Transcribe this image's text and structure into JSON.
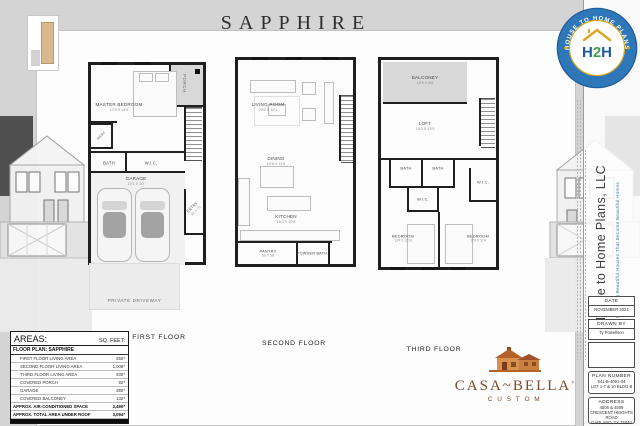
{
  "sheet": {
    "title": "SAPPHIRE"
  },
  "badge": {
    "arc_top": "HOUSE TO HOME PLANS",
    "arc_bottom": "DESIGNING BEAUTIFUL HOUSES THAT BECOME BEAUTIFUL HOMES",
    "m1": "H",
    "m2": "2",
    "m3": "H",
    "ring_color": "#2e77b8",
    "gold_color": "#d9a821",
    "green_color": "#3fa14f"
  },
  "floors": [
    {
      "label": "FIRST FLOOR",
      "rooms": {
        "porch": {
          "name": "PORCH"
        },
        "master": {
          "name": "MASTER BEDROOM",
          "dims": "17'3 X 14'6"
        },
        "wash": {
          "name": "WASH"
        },
        "bath": {
          "name": "BATH"
        },
        "wic": {
          "name": "W.I.C."
        },
        "garage": {
          "name": "GARAGE",
          "dims": "19'1 X 20'"
        },
        "entry": {
          "name": "ENTRY",
          "dims": "4'2 X 7'2"
        },
        "driveway": {
          "name": "PRIVATE DRIVEWAY"
        }
      }
    },
    {
      "label": "SECOND FLOOR",
      "rooms": {
        "living": {
          "name": "LIVING ROOM",
          "dims": "20'6 X 16'1"
        },
        "dining": {
          "name": "DINING",
          "dims": "14'8 X 11'6"
        },
        "kitchen": {
          "name": "KITCHEN",
          "dims": "15'3 X 10'8"
        },
        "pantry": {
          "name": "PANTRY",
          "dims": "5'8 X 5'8"
        },
        "powder": {
          "name": "POWDER BATH"
        }
      }
    },
    {
      "label": "THIRD FLOOR",
      "rooms": {
        "balcony": {
          "name": "BALCONEY",
          "dims": "19'9 X 6'6"
        },
        "loft": {
          "name": "LOFT",
          "dims": "15'3 X 13'9"
        },
        "bath1": {
          "name": "BATH"
        },
        "bath2": {
          "name": "BATH"
        },
        "wic1": {
          "name": "W.I.C."
        },
        "wic2": {
          "name": "W.I.C."
        },
        "bed1": {
          "name": "BEDROOM",
          "dims": "13'4 X 11'10"
        },
        "bed2": {
          "name": "BEDROOM",
          "dims": "12'4 X 11'4"
        }
      }
    }
  ],
  "areas_table": {
    "title": "AREAS:",
    "unit_header": "SQ. FEET:",
    "plan_row": "FLOOR PLAN: SAPPHIRE",
    "rows": [
      {
        "label": "FIRST FLOOR LIVING AREA",
        "value": "550*"
      },
      {
        "label": "SECOND FLOOR LIVING AREA",
        "value": "1,008*"
      },
      {
        "label": "THIRD FLOOR LIVING AREA",
        "value": "930*"
      },
      {
        "label": "COVERED PORCH",
        "value": "92*"
      },
      {
        "label": "GARAGE",
        "value": "380*"
      },
      {
        "label": "COVERED BALCONEY",
        "value": "132*"
      },
      {
        "label": "APPROX. AIR-CONDITIONED SPACE",
        "value": "2,490*"
      },
      {
        "label": "APPROX. TOTAL AREA UNDER ROOF",
        "value": "3,094*"
      }
    ]
  },
  "builder": {
    "name": "CASA~BELLA",
    "registered": "®",
    "sub": "C U S T O M",
    "brand_color": "#7a4a2b"
  },
  "title_block": {
    "company": "House to Home Plans, LLC",
    "tagline": "Designing Beautiful Houses That Become Beautiful Homes",
    "date_label": "DATE",
    "date_value": "NOVEMBER 2024",
    "drawn_by_label": "DRAWN BY",
    "drawn_by_value": "Ty Powellson",
    "plan_number_label": "PLAN NUMBER",
    "plan_number_line1": "541-B-4091-04",
    "plan_number_line2": "LOT 1-7 & 10 BLDG B",
    "address_label": "ADDRESS",
    "address_line1": "4505 & 4509",
    "address_line2": "CRESCENT HEIGHTS ROAD",
    "address_line3": "GARLAND, TX 75040"
  }
}
